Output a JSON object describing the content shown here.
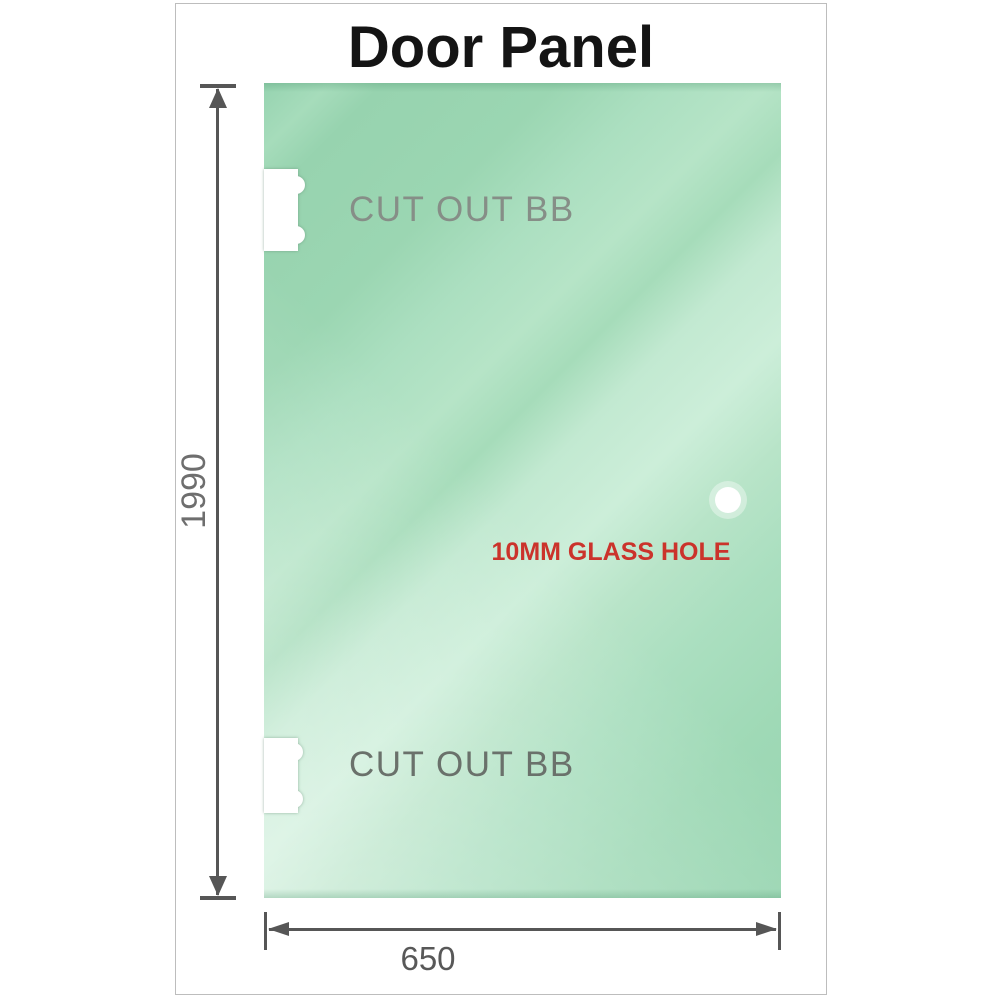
{
  "title": "Door Panel",
  "panel": {
    "cutout_top_label": "CUT OUT BB",
    "cutout_bottom_label": "CUT OUT BB",
    "glass_hole_label": "10MM GLASS HOLE"
  },
  "dimensions": {
    "height_label": "1990",
    "width_label": "650"
  },
  "colors": {
    "glass_green": "#a6dcba",
    "glass_highlight": "#cceed9",
    "annotation_red": "#cb332b",
    "dimension_gray": "#565656",
    "cutout_label_gray": "#79817a",
    "card_border_gray": "#bdbdbd",
    "title_black": "#141414"
  }
}
